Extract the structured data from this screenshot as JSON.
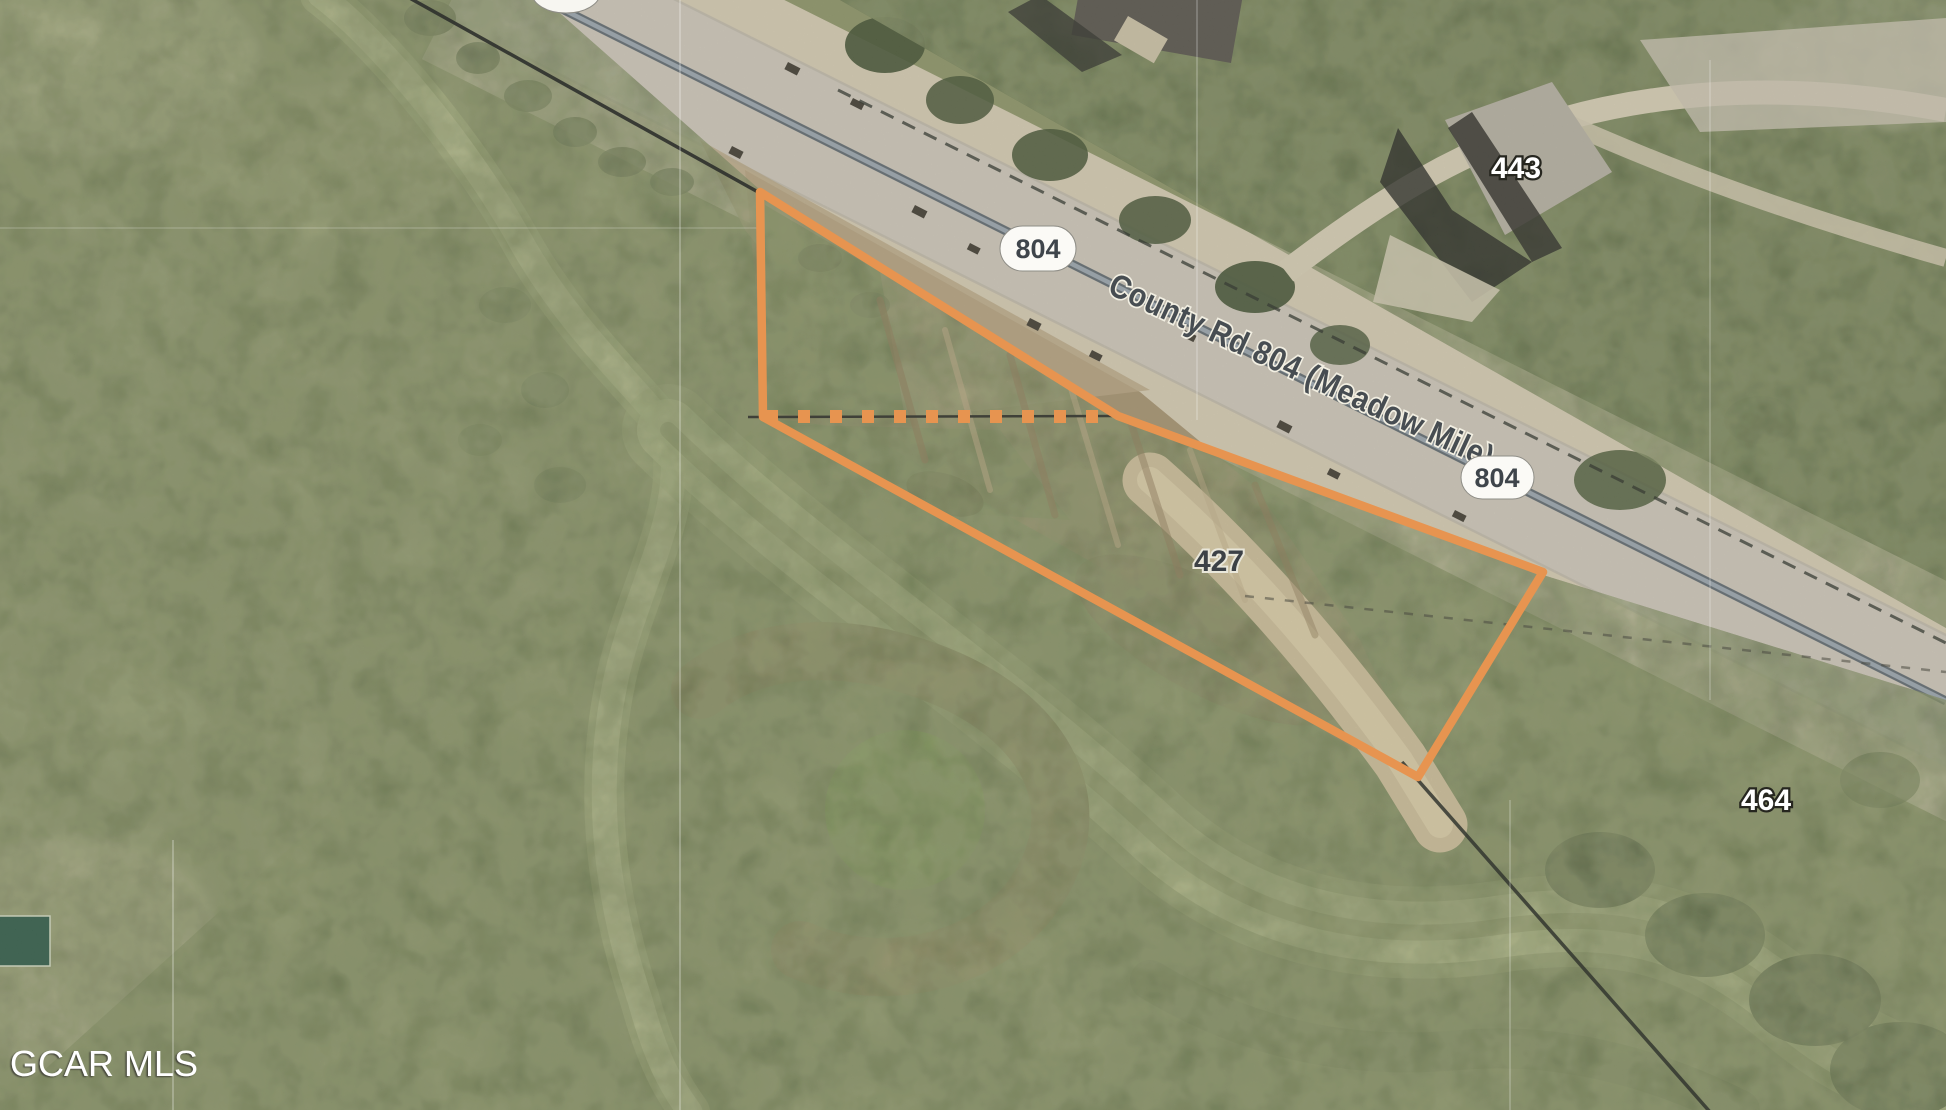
{
  "road": {
    "name": "County Rd 804 (Meadow Mile)",
    "shield_nw": "804",
    "shield_se": "804"
  },
  "parcels": {
    "north_label": "443",
    "subject_label": "427",
    "east_label": "464"
  },
  "watermark": "GCAR MLS",
  "colors": {
    "parcel_highlight": "#E79450",
    "road_label": "#474D52",
    "shield_text": "#3F454B",
    "parcel_label_light": "#FFFFFF",
    "parcel_label_dark": "#3C4146"
  }
}
